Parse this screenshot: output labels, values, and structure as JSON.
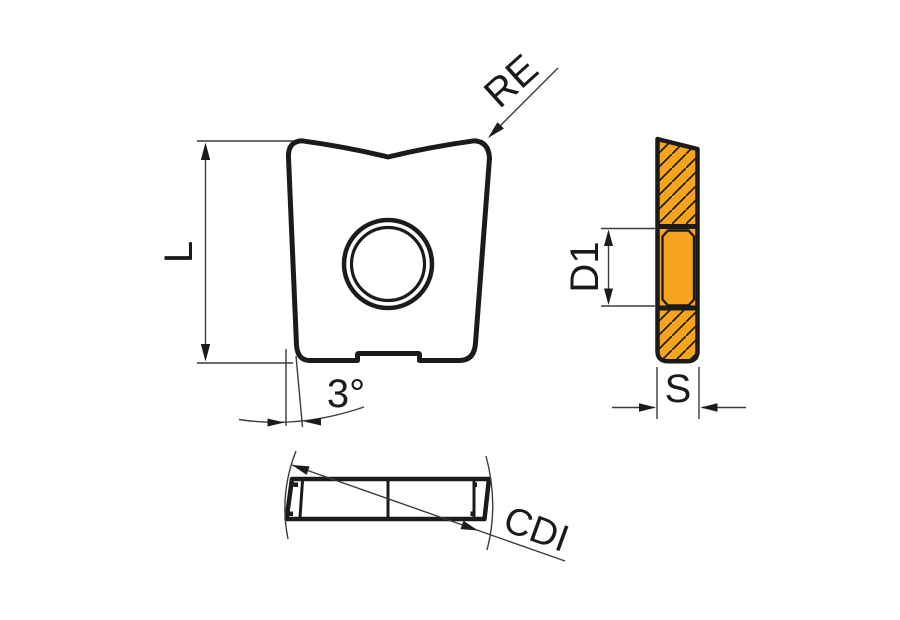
{
  "diagram": {
    "labels": {
      "re": "RE",
      "l": "L",
      "angle": "3°",
      "d1": "D1",
      "s": "S",
      "cdi": "CDI"
    },
    "colors": {
      "insert": "#F6A41D",
      "outline": "#1B1B1B",
      "dim_lines": "#3C3C3C",
      "hole": "#FFFFFF",
      "background": "#FFFFFF"
    }
  }
}
